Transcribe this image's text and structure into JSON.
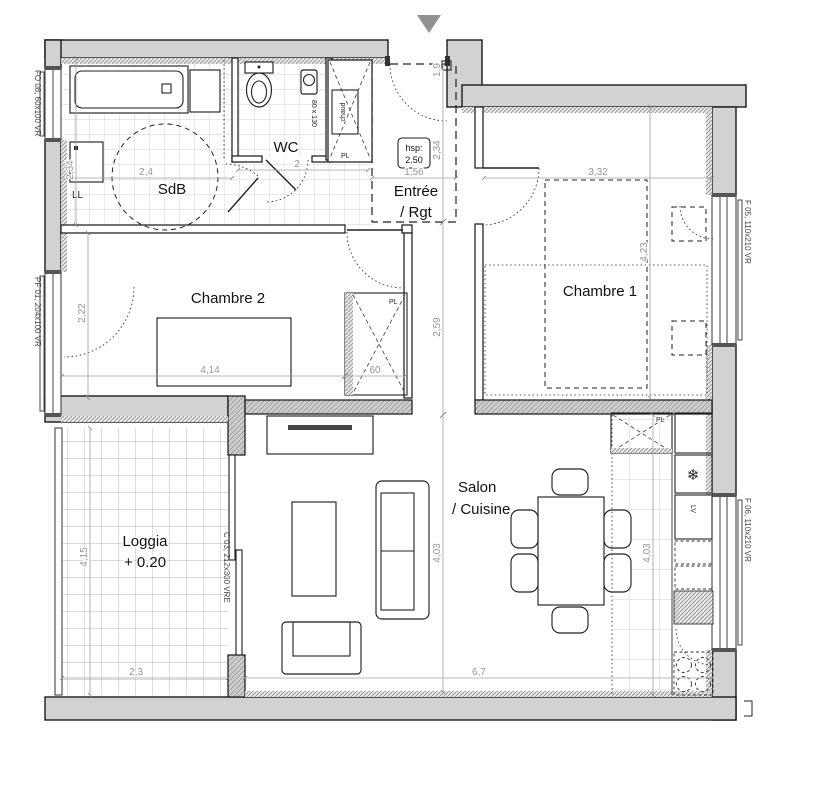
{
  "plan": {
    "rooms": {
      "sdb": "SdB",
      "wc": "WC",
      "entree_line1": "Entrée",
      "entree_line2": "/ Rgt",
      "chambre1": "Chambre 1",
      "chambre2": "Chambre 2",
      "loggia_line1": "Loggia",
      "loggia_line2": "+ 0.20",
      "salon_line1": "Salon",
      "salon_line2": "/ Cuisine"
    },
    "ceiling_height": {
      "label": "hsp:",
      "value": "2.50"
    },
    "fixtures": {
      "washing_machine": "LL",
      "water_heater": "chaud",
      "closet_chaud": "PL",
      "closet_chambre2": "PL",
      "closet_kitchen": "PL",
      "dishwasher": "LV",
      "wc_size": "80 x 130"
    },
    "openings": {
      "fo08": "FO 08, 60x100 VR",
      "pf01": "PF 01, 204x100 VR",
      "f05": "F 05, 110x210 VR",
      "f06": "F 06, 110x210 VR",
      "c03": "C 03, 212x300 VRE"
    },
    "dimensions": {
      "sdb_width": "2,4",
      "sdb_depth": "2,34",
      "wc_width": "2",
      "entree_width": "1,56",
      "entree_depth": "2,34",
      "entrance_door": "1,9",
      "hall_depth": "2,59",
      "chambre1_width": "3,32",
      "chambre1_depth": "4,23",
      "chambre2_depth": "2,22",
      "chambre2_width": "4,14",
      "closet_width": "60",
      "salon_depth_mid": "4,03",
      "salon_depth_right": "4,03",
      "salon_width": "6,7",
      "loggia_depth": "4,15",
      "loggia_width": "2,3"
    },
    "icons": {
      "fridge_snowflake": "❄"
    },
    "colors": {
      "wall_fill": "#d2d2d2",
      "line": "#1a1a1a",
      "dimension_text": "#969696",
      "arrow": "#8f9194"
    }
  }
}
